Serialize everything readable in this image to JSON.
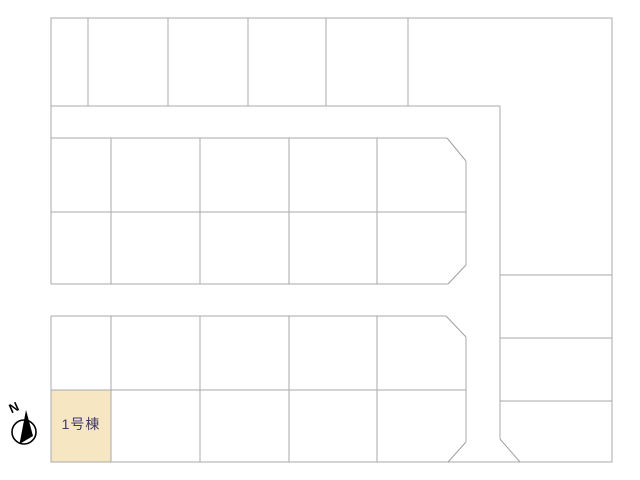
{
  "map": {
    "highlighted_lot": {
      "label": "1号棟"
    },
    "compass": {
      "north_label": "N"
    }
  },
  "colors": {
    "background": "#ffffff",
    "lot_line": "#a9a9a9",
    "highlight_fill": "#f6e6c2",
    "highlight_label": "#413a66",
    "compass": "#000000"
  }
}
